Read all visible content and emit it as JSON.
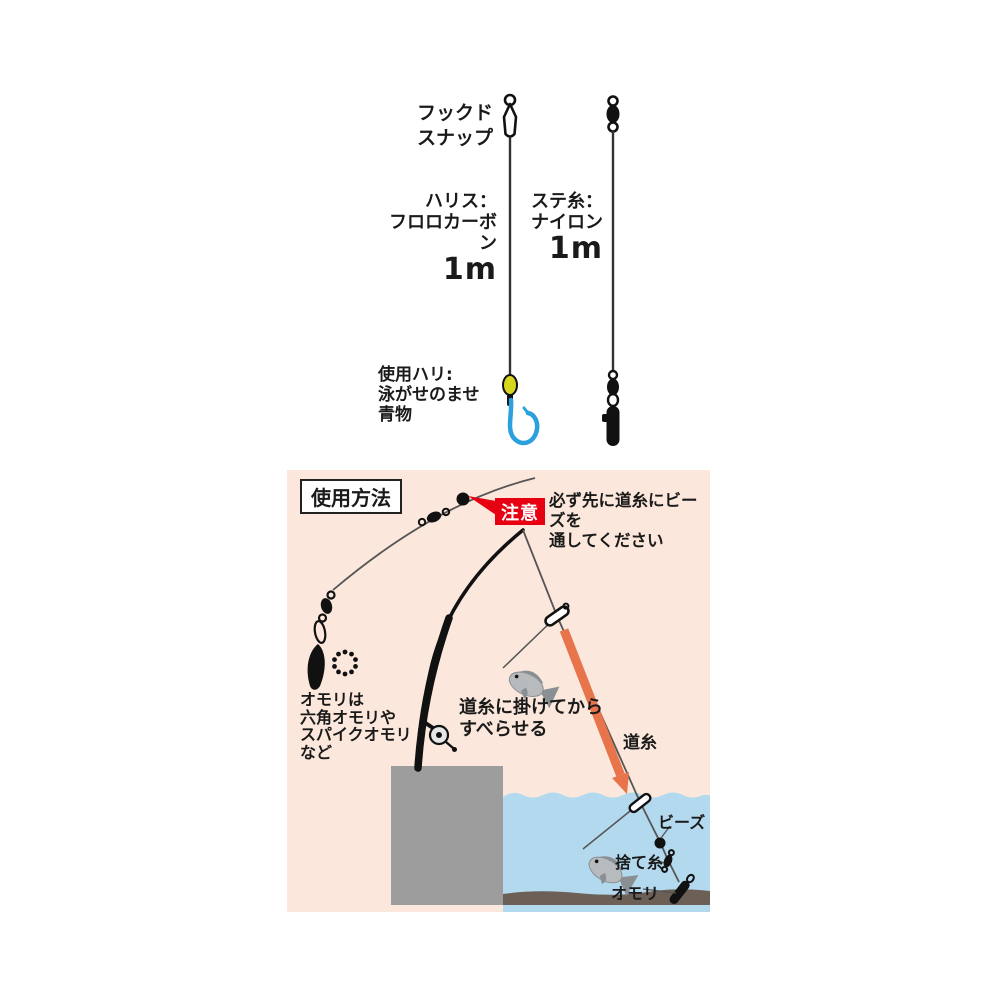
{
  "top": {
    "left_rig": {
      "snap_label_1": "フックド",
      "snap_label_2": "スナップ",
      "line_label_1": "ハリス：",
      "line_label_2": "フロロカーボン",
      "line_length": "1m",
      "hook_label_1": "使用ハリ:",
      "hook_label_2": "泳がせのませ",
      "hook_label_3": "青物"
    },
    "right_rig": {
      "line_label_1": "ステ糸：",
      "line_label_2": "ナイロン",
      "line_length": "1m"
    }
  },
  "usage": {
    "title": "使用方法",
    "caution_badge": "注意",
    "caution_text_1": "必ず先に道糸にビーズを",
    "caution_text_2": "通してください",
    "weight_note_1": "オモリは",
    "weight_note_2": "六角オモリや",
    "weight_note_3": "スパイクオモリ",
    "weight_note_4": "など",
    "slide_note_1": "道糸に掛けてから",
    "slide_note_2": "すべらせる",
    "main_line_label": "道糸",
    "beads_label": "ビーズ",
    "sacrifice_line_label": "捨て糸",
    "weight_label": "オモリ"
  },
  "colors": {
    "panel_pink": "#fbe7db",
    "caution_red": "#e60012",
    "arrow_orange": "#e7744a",
    "hook_blue": "#2aa0dc",
    "bead_yellow": "#d6d61e",
    "water_blue": "#b3d9ee",
    "pier_gray": "#9d9d9d",
    "sea_floor_brown": "#6b5f56",
    "line_black": "#333333"
  }
}
